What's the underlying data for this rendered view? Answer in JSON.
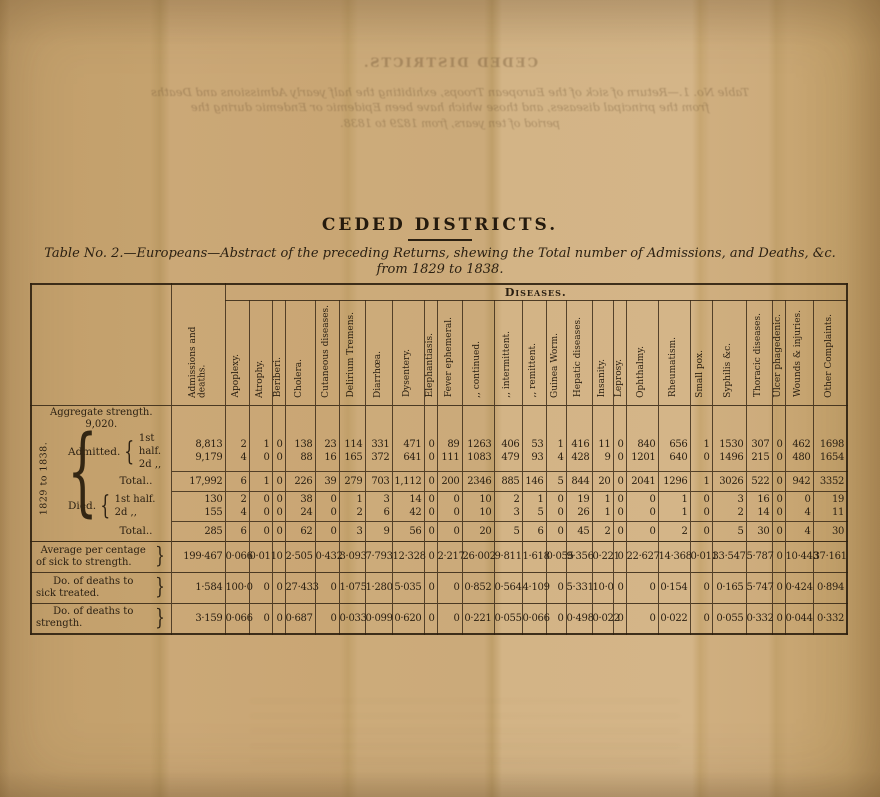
{
  "page": {
    "title": "CEDED DISTRICTS.",
    "subtitle_line1": "Table No. 2.—Europeans—Abstract of the preceding Returns, shewing the Total number of Admissions, and Deaths, &c.",
    "subtitle_line2": "from 1829 to 1838."
  },
  "show_through": {
    "line1": "CEDED DISTRICTS.",
    "line2": "Table No. 1.—Return of sick of the European Troops, exhibiting the half yearly Admissions and Deaths",
    "line3": "from the principal diseases, and those which have been Epidemic or Endemic during the",
    "line4": "period of ten years, from 1829 to 1838."
  },
  "table": {
    "diseases_header": "Diseases.",
    "side_label": "1829 to 1838.",
    "brace_open": "{",
    "brace_close": "}",
    "columns": [
      "Admissions and deaths.",
      "Apoplexy.",
      "Atrophy.",
      "Beriberi.",
      "Cholera.",
      "Cutaneous diseases.",
      "Delirium Tremens.",
      "Diarrhœa.",
      "Dysentery.",
      "Elephantiasis.",
      "Fever ephemeral.",
      ",,  continued.",
      ",,  intermittent.",
      ",,  remittent.",
      "Guinea Worm.",
      "Hepatic diseases.",
      "Insanity.",
      "Leprosy.",
      "Ophthalmy.",
      "Rheumatism.",
      "Small pox.",
      "Syphilis &c.",
      "Thoracic diseases.",
      "Ulcer phagedenic.",
      "Wounds & injuries.",
      "Other Complaints."
    ],
    "rows": [
      {
        "kind": "aggregate",
        "label1": "Aggregate strength.",
        "label2": "9,020."
      },
      {
        "kind": "pair",
        "group": "Admitted.",
        "line1_label": "1st half.",
        "line2_label": "2d  ,,",
        "line1": [
          "8,813",
          "2",
          "1",
          "0",
          "138",
          "23",
          "114",
          "331",
          "471",
          "0",
          "89",
          "1263",
          "406",
          "53",
          "1",
          "416",
          "11",
          "0",
          "840",
          "656",
          "1",
          "1530",
          "307",
          "0",
          "462",
          "1698"
        ],
        "line2": [
          "9,179",
          "4",
          "0",
          "0",
          "88",
          "16",
          "165",
          "372",
          "641",
          "0",
          "111",
          "1083",
          "479",
          "93",
          "4",
          "428",
          "9",
          "0",
          "1201",
          "640",
          "0",
          "1496",
          "215",
          "0",
          "480",
          "1654"
        ]
      },
      {
        "kind": "total",
        "label": "Total..",
        "values": [
          "17,992",
          "6",
          "1",
          "0",
          "226",
          "39",
          "279",
          "703",
          "1,112",
          "0",
          "200",
          "2346",
          "885",
          "146",
          "5",
          "844",
          "20",
          "0",
          "2041",
          "1296",
          "1",
          "3026",
          "522",
          "0",
          "942",
          "3352"
        ]
      },
      {
        "kind": "pair",
        "group": "Died.",
        "line1_label": "1st half.",
        "line2_label": "2d  ,,",
        "line1": [
          "130",
          "2",
          "0",
          "0",
          "38",
          "0",
          "1",
          "3",
          "14",
          "0",
          "0",
          "10",
          "2",
          "1",
          "0",
          "19",
          "1",
          "0",
          "0",
          "1",
          "0",
          "3",
          "16",
          "0",
          "0",
          "19"
        ],
        "line2": [
          "155",
          "4",
          "0",
          "0",
          "24",
          "0",
          "2",
          "6",
          "42",
          "0",
          "0",
          "10",
          "3",
          "5",
          "0",
          "26",
          "1",
          "0",
          "0",
          "1",
          "0",
          "2",
          "14",
          "0",
          "4",
          "11"
        ]
      },
      {
        "kind": "total",
        "label": "Total..",
        "values": [
          "285",
          "6",
          "0",
          "0",
          "62",
          "0",
          "3",
          "9",
          "56",
          "0",
          "0",
          "20",
          "5",
          "6",
          "0",
          "45",
          "2",
          "0",
          "0",
          "2",
          "0",
          "5",
          "30",
          "0",
          "4",
          "30"
        ]
      },
      {
        "kind": "percent",
        "label1": "Average per centage",
        "label2": "of sick to strength.",
        "values": [
          "199·467",
          "0·066",
          "0·011",
          "0",
          "2·505",
          "0·432",
          "3·093",
          "7·793",
          "12·328",
          "0",
          "2·217",
          "26·002",
          "9·811",
          "1·618",
          "0·055",
          "9·356",
          "0·221",
          "0",
          "22·627",
          "14·368",
          "0·011",
          "33·547",
          "5·787",
          "0",
          "10·443",
          "37·161"
        ]
      },
      {
        "kind": "percent",
        "label1": "Do. of deaths to",
        "label2": "sick treated.",
        "values": [
          "1·584",
          "100·0",
          "0",
          "0",
          "27·433",
          "0",
          "1·075",
          "1·280",
          "5·035",
          "0",
          "0",
          "0·852",
          "0·564",
          "4·109",
          "0",
          "5·331",
          "10·0",
          "0",
          "0",
          "0·154",
          "0",
          "0·165",
          "5·747",
          "0",
          "0·424",
          "0·894"
        ]
      },
      {
        "kind": "percent",
        "label1": "Do. of deaths to",
        "label2": "strength.",
        "values": [
          "3·159",
          "0·066",
          "0",
          "0",
          "0·687",
          "0",
          "0·033",
          "0·099",
          "0·620",
          "0",
          "0",
          "0·221",
          "0·055",
          "0·066",
          "0",
          "0·498",
          "0·022",
          "0",
          "0",
          "0·022",
          "0",
          "0·055",
          "0·332",
          "0",
          "0·044",
          "0·332"
        ]
      }
    ]
  }
}
